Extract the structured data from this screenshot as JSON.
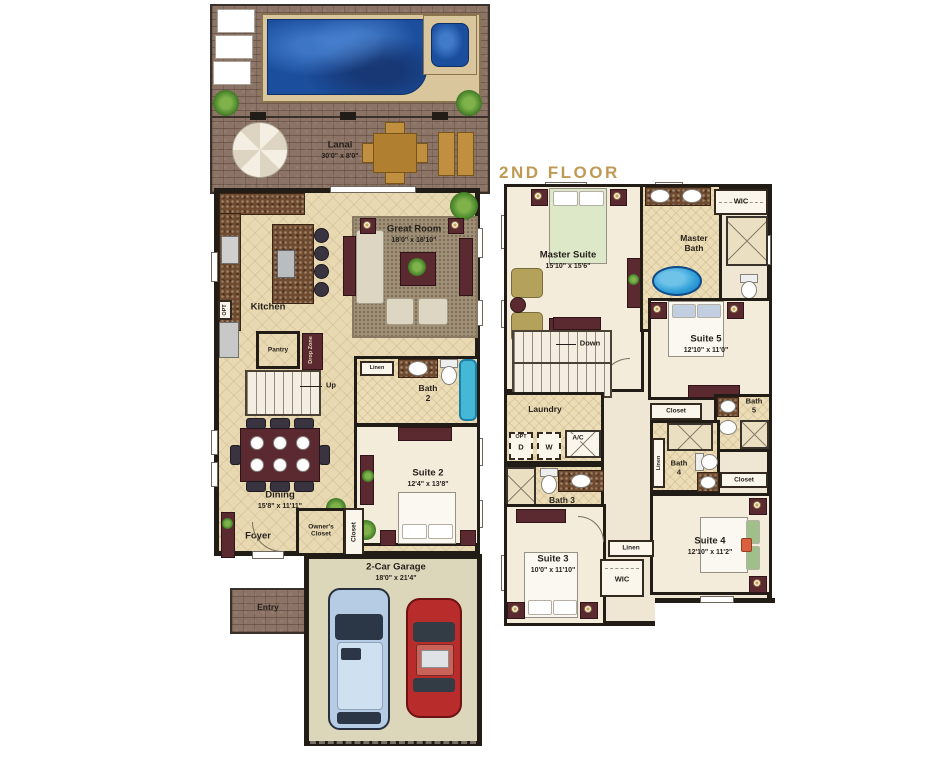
{
  "colors": {
    "header_gold": "#bf9a55",
    "pool_blue": "#1b4f9e",
    "tub_cyan": "#45b8d8",
    "wall": "#221c16"
  },
  "floor1": {
    "lanai_name": "Lanai",
    "lanai_dims": "30'0\" x 8'0\"",
    "great_room_name": "Great Room",
    "great_room_dims": "18'0\" x 18'10\"",
    "kitchen": "Kitchen",
    "pantry": "Pantry",
    "drop_zone": "Drop Zone",
    "opt": "OPT",
    "up": "Up",
    "linen": "Linen",
    "bath2_l1": "Bath",
    "bath2_l2": "2",
    "suite2_name": "Suite 2",
    "suite2_dims": "12'4\" x 13'8\"",
    "dining_name": "Dining",
    "dining_dims": "15'8\" x 11'11\"",
    "foyer": "Foyer",
    "owners_closet_l1": "Owner's",
    "owners_closet_l2": "Closet",
    "closet": "Closet",
    "entry": "Entry",
    "garage_name": "2-Car Garage",
    "garage_dims": "18'0\" x 21'4\""
  },
  "floor2": {
    "header": "2ND FLOOR",
    "master_suite_name": "Master Suite",
    "master_suite_dims": "15'10\" x 15'6\"",
    "master_bath_l1": "Master",
    "master_bath_l2": "Bath",
    "wic": "WIC",
    "down": "Down",
    "suite5_name": "Suite 5",
    "suite5_dims": "12'10\" x 11'0\"",
    "laundry": "Laundry",
    "opt": "OPT",
    "d": "D",
    "w": "W",
    "ac": "A/C",
    "bath3": "Bath 3",
    "bath5_l1": "Bath",
    "bath5_l2": "5",
    "bath4_l1": "Bath",
    "bath4_l2": "4",
    "closet": "Closet",
    "linen": "Linen",
    "suite3_name": "Suite 3",
    "suite3_dims": "10'0\" x 11'10\"",
    "suite4_name": "Suite 4",
    "suite4_dims": "12'10\" x 11'2\""
  }
}
